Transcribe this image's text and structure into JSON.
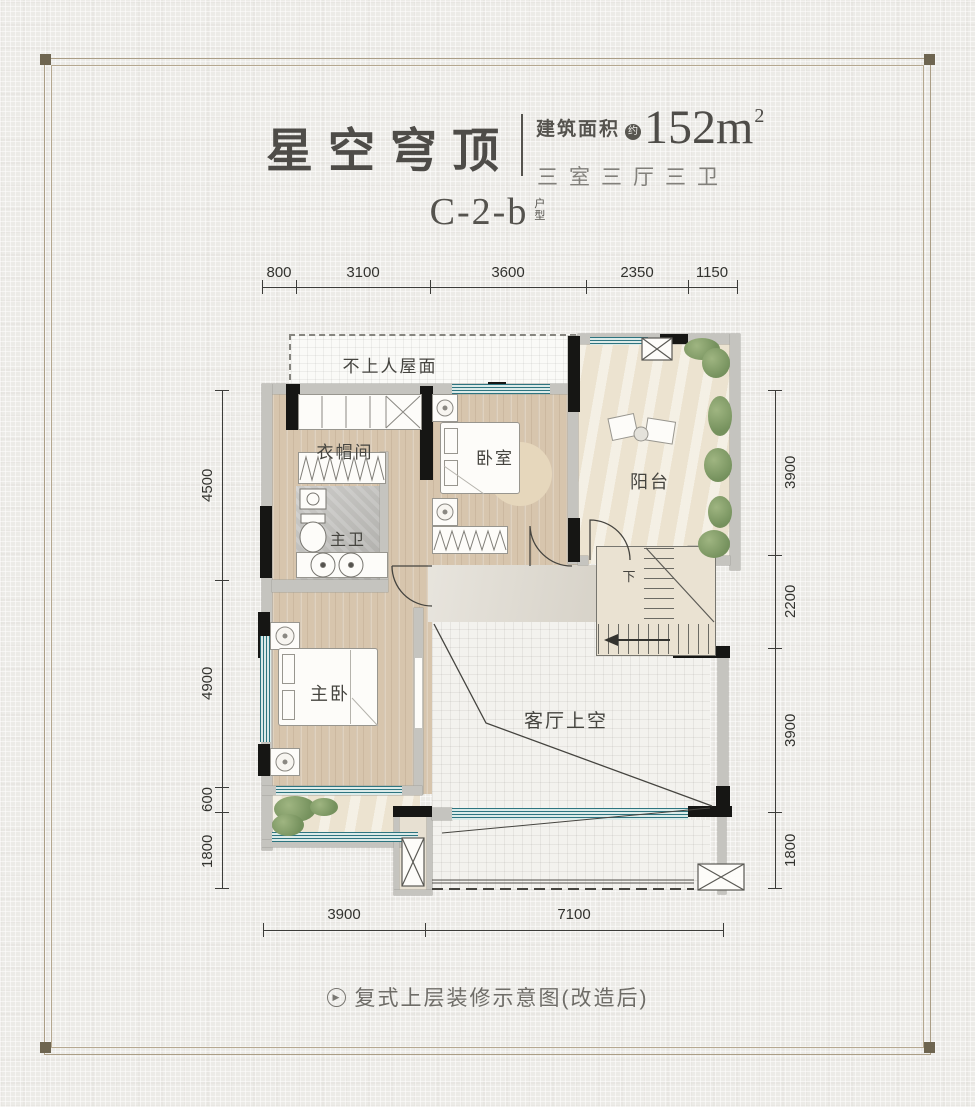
{
  "header": {
    "title": "星空穹顶",
    "area_label": "建筑面积",
    "area_approx": "约",
    "area_value": "152m",
    "area_exponent": "2",
    "layout_summary": "三室三厅三卫",
    "unit_code": "C-2-b",
    "unit_type_top": "户",
    "unit_type_bottom": "型"
  },
  "rooms": {
    "roof": "不上人屋面",
    "cloakroom": "衣帽间",
    "master_bath": "主卫",
    "bedroom": "卧室",
    "balcony": "阳台",
    "master_bedroom": "主卧",
    "living_void": "客厅上空",
    "stairs_down": "下"
  },
  "dimensions": {
    "top": [
      "800",
      "3100",
      "3600",
      "2350",
      "1150"
    ],
    "left": [
      "4500",
      "4900",
      "600",
      "1800"
    ],
    "right": [
      "3900",
      "2200",
      "3900",
      "1800"
    ],
    "bottom": [
      "3900",
      "7100"
    ]
  },
  "caption": {
    "text": "复式上层装修示意图(改造后)"
  },
  "colors": {
    "page_bg": "#ecebe7",
    "frame": "#ab9e86",
    "corner_dot": "#6e6550",
    "title_ink": "#4e4c48",
    "wood_floor": "#d7c5ad",
    "balcony_floor": "#ece3d0",
    "tile_floor": "#b7b6b2",
    "stone_floor": "#dbd6cb",
    "void_bg": "#f3f2ee",
    "wall_gray": "#c5c4bf",
    "wall_black": "#161614",
    "window_teal": "#2e7580",
    "plant_green": "#75915d"
  }
}
